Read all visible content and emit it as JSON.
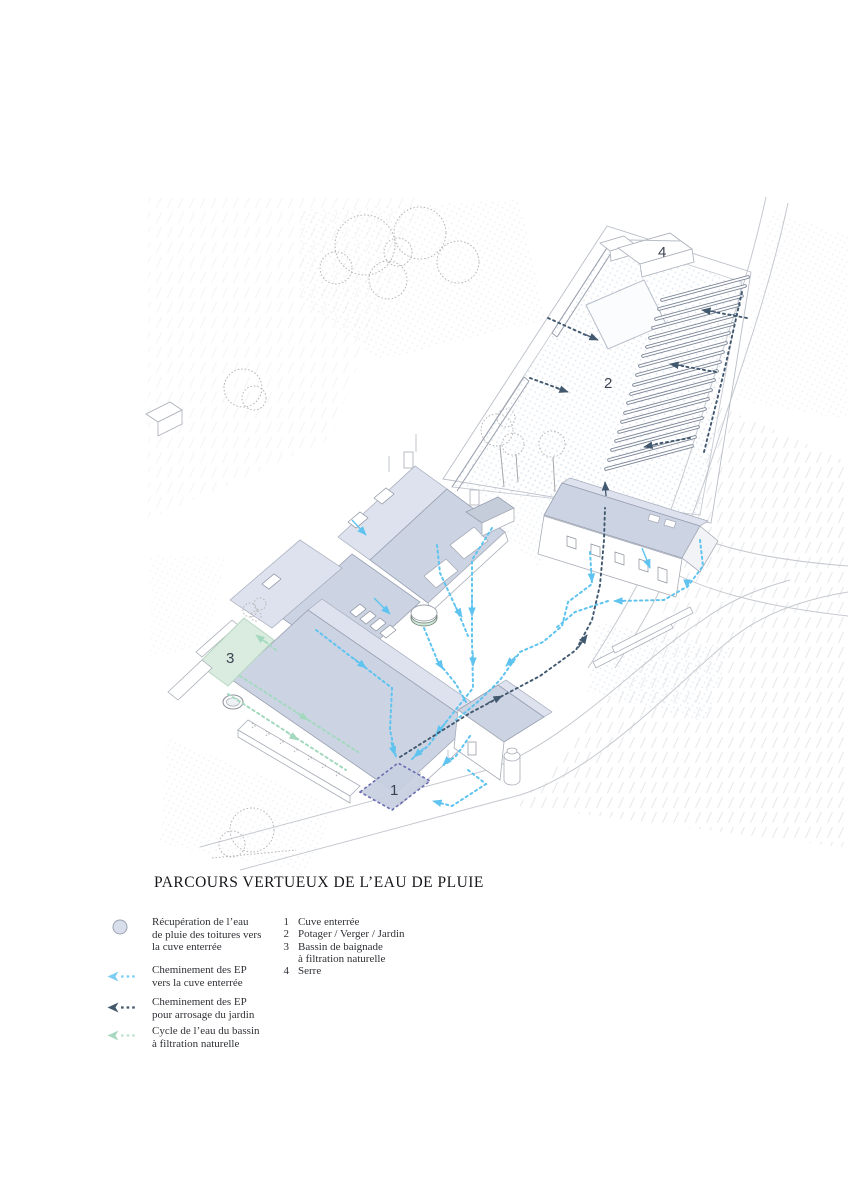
{
  "title": "PARCOURS VERTUEUX DE L’EAU DE PLUIE",
  "markers": {
    "cuve": "1",
    "potager": "2",
    "bassin": "3",
    "serre": "4"
  },
  "legend": {
    "symbol_items": [
      {
        "symbol": "circle",
        "color": "#d8deea",
        "lines": [
          "Récupération de l’eau",
          "de pluie des toitures vers",
          "la cuve enterrée"
        ]
      },
      {
        "symbol": "arrow",
        "color": "#7ecdf3",
        "lines": [
          "Cheminement des EP",
          "vers la cuve enterrée"
        ]
      },
      {
        "symbol": "arrow",
        "color": "#44586c",
        "lines": [
          "Cheminement des EP",
          "pour arrosage du jardin"
        ]
      },
      {
        "symbol": "arrow",
        "color": "#a8d8c0",
        "lines": [
          "Cycle de l’eau du bassin",
          "à filtration naturelle"
        ]
      }
    ],
    "numbered_items": [
      {
        "num": "1",
        "lines": [
          "Cuve enterrée"
        ]
      },
      {
        "num": "2",
        "lines": [
          "Potager / Verger / Jardin"
        ]
      },
      {
        "num": "3",
        "lines": [
          "Bassin de baignade",
          "à filtration naturelle"
        ]
      },
      {
        "num": "4",
        "lines": [
          "Serre"
        ]
      }
    ]
  },
  "colors": {
    "roof": "#ccd4e4",
    "rain_path": "#5fc3ef",
    "garden_path": "#42586e",
    "pond_cycle": "#a5d9bf",
    "tank_outline": "#6b6cb0",
    "pool_fill": "#d9ecdf"
  }
}
